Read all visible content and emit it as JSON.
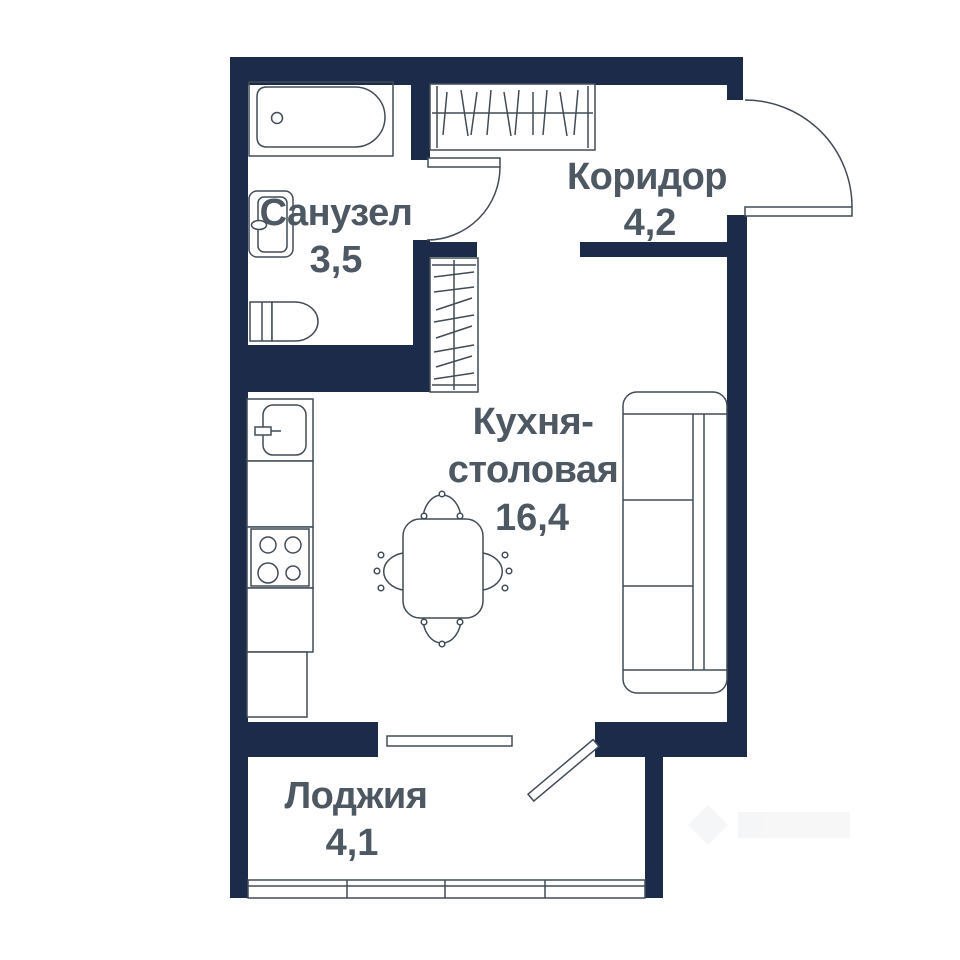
{
  "rooms": {
    "bathroom": {
      "label": "Санузел",
      "area": "3,5"
    },
    "corridor": {
      "label": "Коридор",
      "area": "4,2"
    },
    "kitchen": {
      "label_line1": "Кухня-",
      "label_line2": "столовая",
      "area": "16,4"
    },
    "loggia": {
      "label": "Лоджия",
      "area": "4,1"
    }
  },
  "colors": {
    "wall": "#1d2b4b",
    "line": "#414c57",
    "label_text": "#4d5862",
    "background": "#ffffff"
  }
}
